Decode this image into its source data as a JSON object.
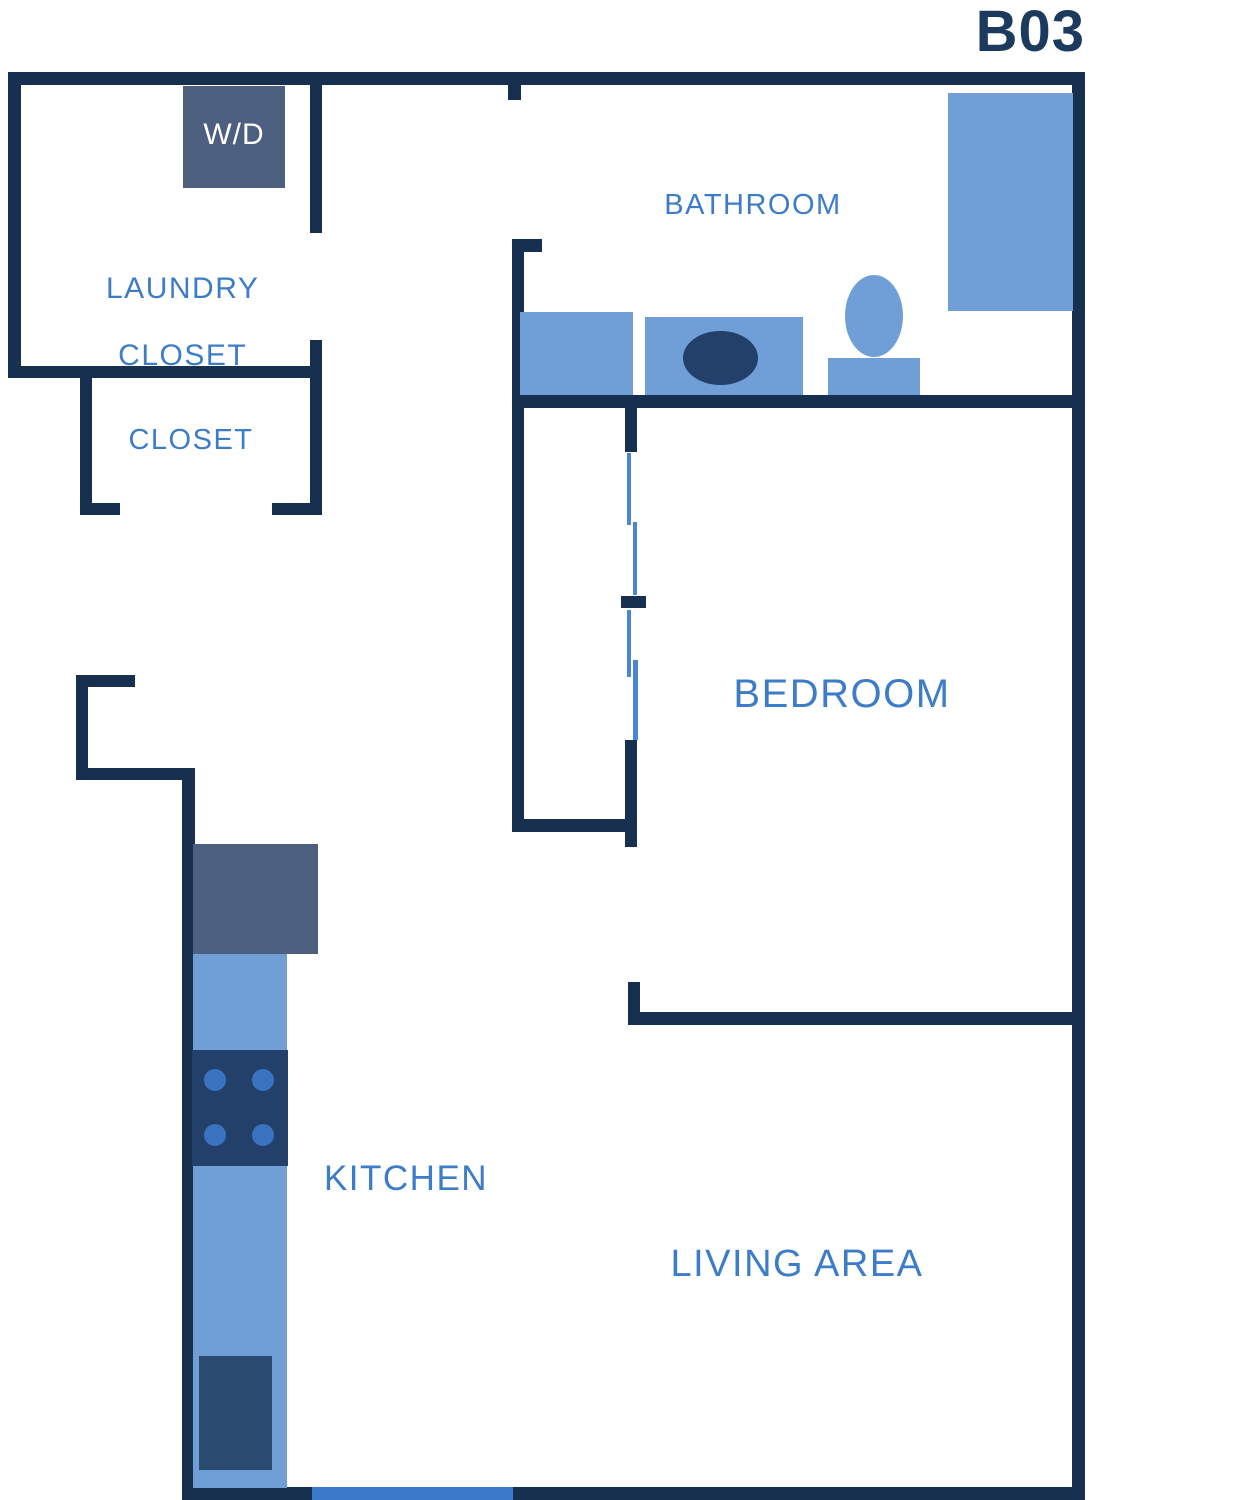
{
  "title": "B03",
  "colors": {
    "wall": "#17304f",
    "title_text": "#1b3a5e",
    "room_label": "#3d7cc9",
    "fixture_blue": "#6f9fd6",
    "appliance_slate": "#4d5f7e",
    "appliance_navy": "#23406a",
    "sink_navy": "#2b4a70",
    "burner_blue": "#3a73c0",
    "door_blue": "#3a78c9",
    "slider_blue": "#4a86d4"
  },
  "labels": {
    "washer_dryer": "W/D",
    "laundry_line1": "LAUNDRY",
    "laundry_line2": "CLOSET",
    "closet": "CLOSET",
    "bathroom": "BATHROOM",
    "bedroom": "BEDROOM",
    "kitchen": "KITCHEN",
    "living_area": "LIVING AREA"
  }
}
